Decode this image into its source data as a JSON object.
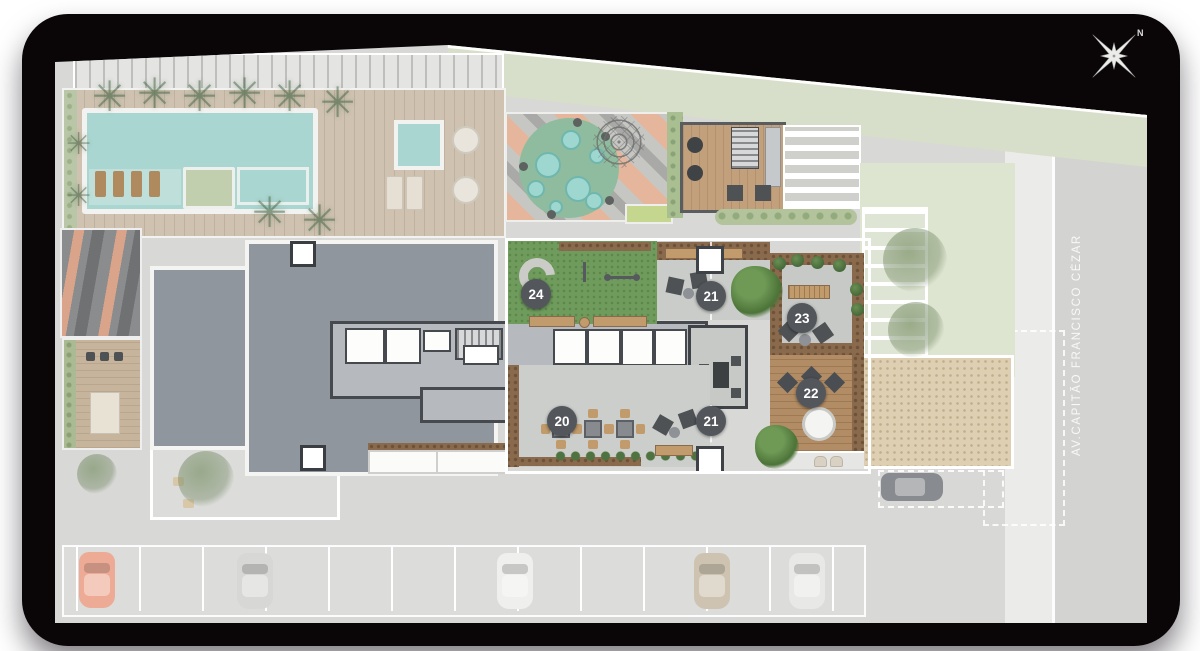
{
  "street": {
    "name": "AV.CAPITÃO FRANCISCO CÉZAR"
  },
  "compass": {
    "north": "N"
  },
  "badges": [
    {
      "label": "24"
    },
    {
      "label": "21"
    },
    {
      "label": "23"
    },
    {
      "label": "22"
    },
    {
      "label": "20"
    },
    {
      "label": "21"
    }
  ],
  "icons": {
    "palm": "✳"
  },
  "colors": {
    "badge": "#53575c",
    "highlight_lawn": "#6f9c5d",
    "pool_water": "#a9d6d0",
    "stripe_salmon": "#e6b69c",
    "sand": "#decfb3",
    "wood_deck": "#b28c64",
    "tower_slab": "#8f969e",
    "mat_background": "#0a0608"
  }
}
